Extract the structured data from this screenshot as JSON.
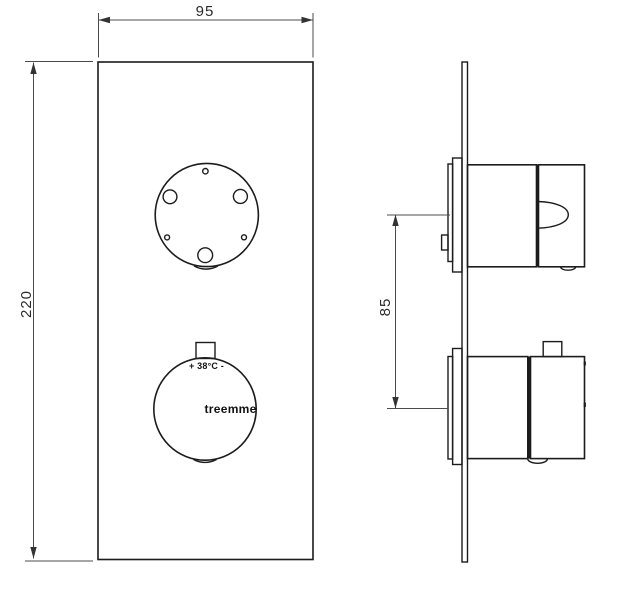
{
  "drawing": {
    "type": "technical-drawing",
    "subject": "thermostatic shower mixer wall plate, front and side view"
  },
  "dimensions": {
    "plate_width": "95",
    "plate_height": "220",
    "handle_spacing": "85"
  },
  "labels": {
    "temperature": "+ 38°C -",
    "brand": "treemme"
  },
  "colors": {
    "line": "#1c1c1c",
    "dimension_line": "#4c4c4c",
    "text": "#2b2b2b",
    "background": "#ffffff"
  }
}
